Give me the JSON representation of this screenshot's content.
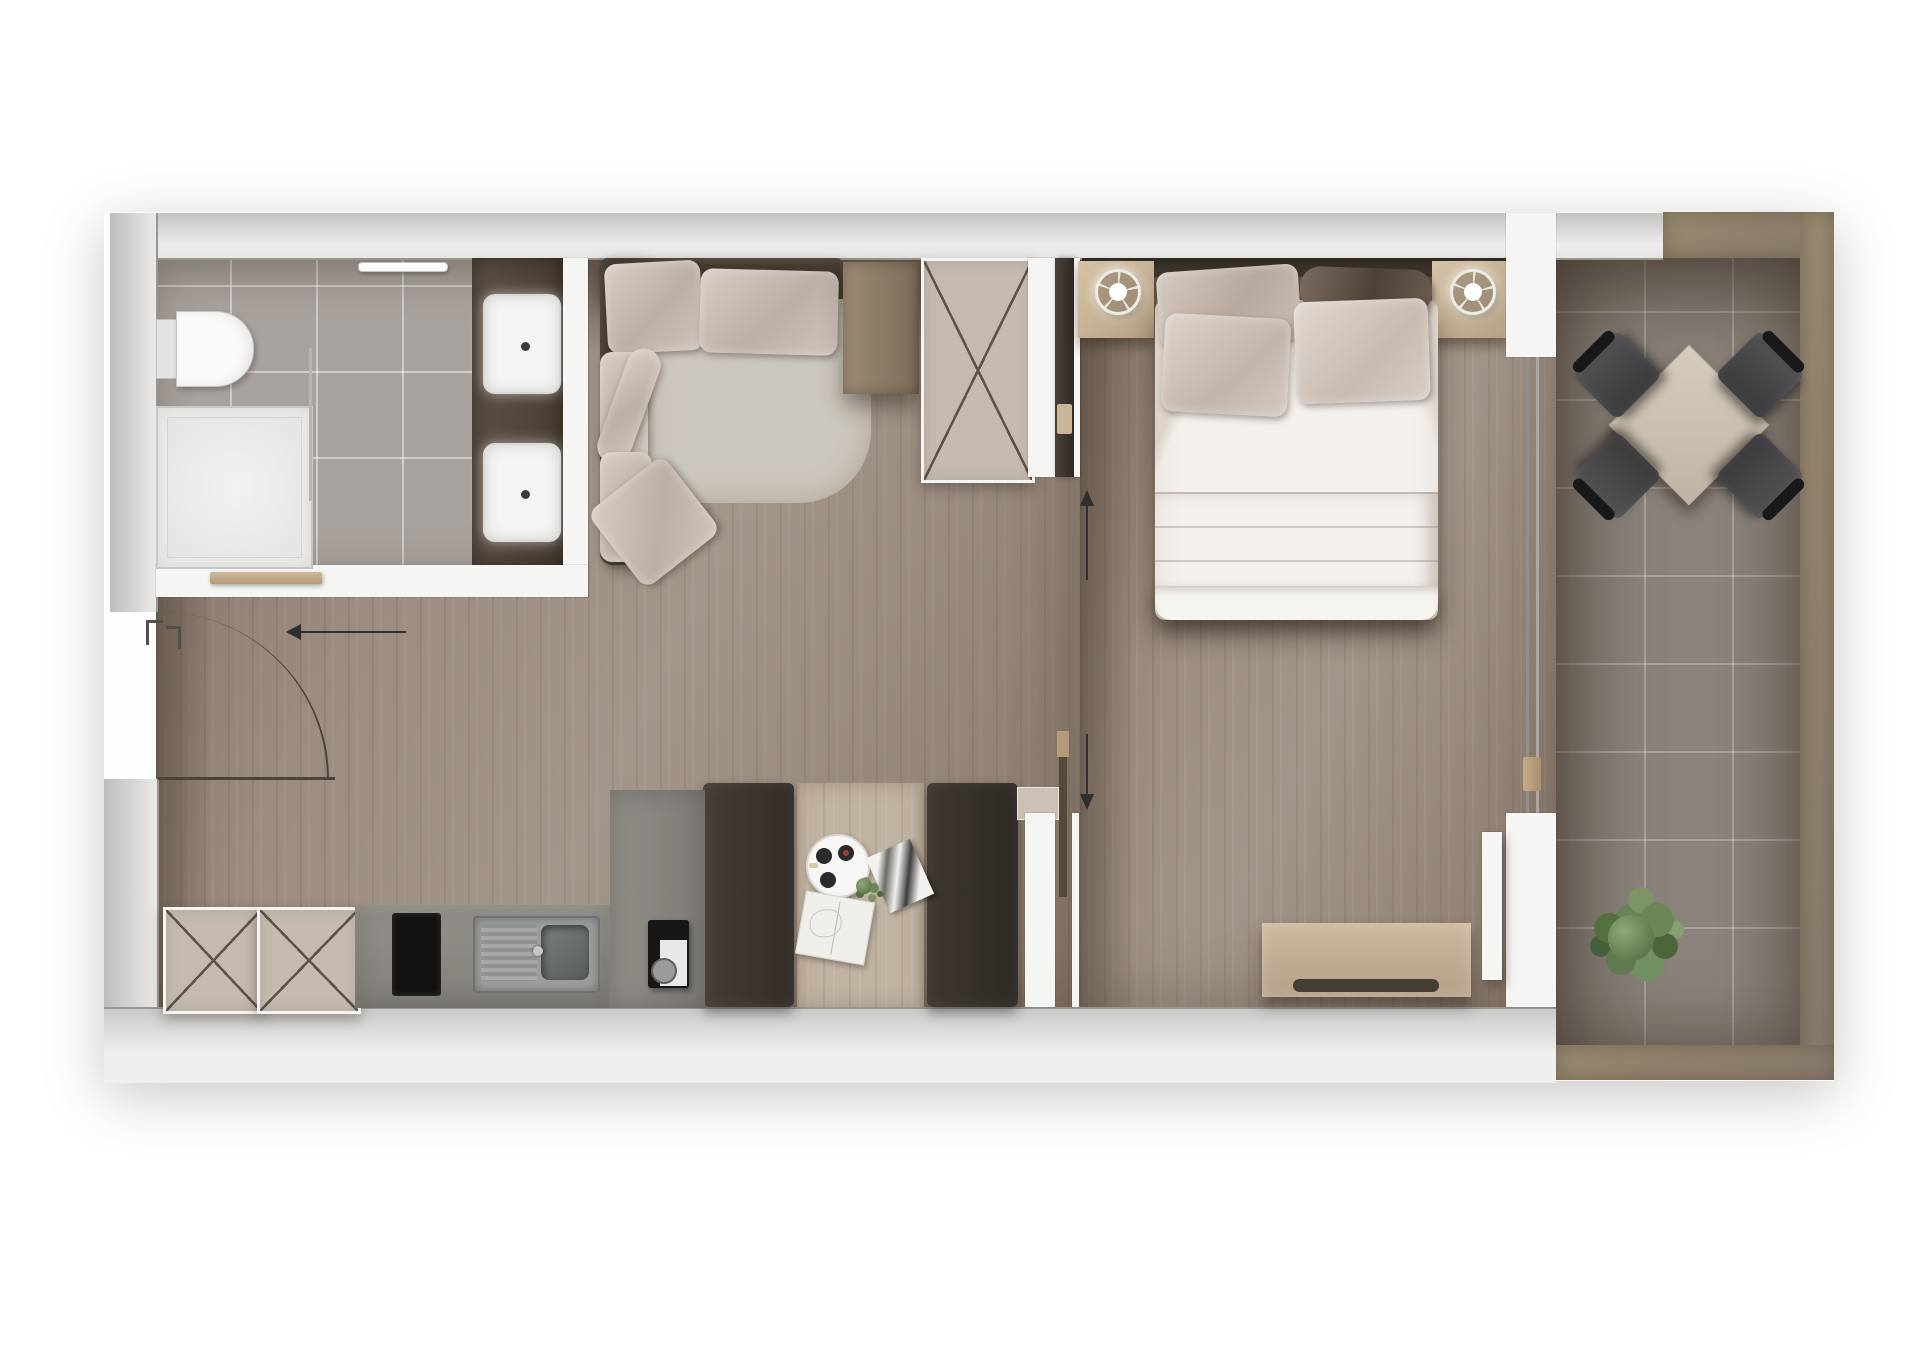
{
  "title": "one-bedroom apartment floor plan, rendered top view",
  "visible_text": [],
  "rooms": [
    {
      "name": "bathroom",
      "items": [
        "toilet",
        "shower-tray",
        "shower-glass-partition",
        "towel-rail",
        "vanity-counter",
        "sink",
        "sink"
      ]
    },
    {
      "name": "entry-hall",
      "items": [
        "entry-door-swing-arc",
        "entry-direction-arrow",
        "console-shelf",
        "shoe-cabinet-x",
        "shoe-cabinet-x"
      ]
    },
    {
      "name": "living-kitchen",
      "items": [
        "corner-sofa",
        "sofa-pillows",
        "side-table",
        "wardrobe-x",
        "kitchen-counter",
        "cooktop",
        "kitchen-sink",
        "coffee-machine",
        "dining-booth-bench",
        "dining-table",
        "serving-tray",
        "magazine",
        "small-plant",
        "open-book",
        "dining-booth-bench"
      ]
    },
    {
      "name": "bedroom",
      "items": [
        "headboard",
        "nightstand-left",
        "table-lamp-left",
        "double-bed",
        "bed-pillows",
        "duvet",
        "blanket",
        "nightstand-right",
        "table-lamp-right",
        "dresser",
        "sliding-door",
        "slide-direction-arrows"
      ]
    },
    {
      "name": "balcony",
      "items": [
        "sliding-glass-door",
        "square-table-diagonal",
        "chair",
        "chair",
        "chair",
        "chair",
        "potted-plant"
      ]
    }
  ],
  "counts": {
    "bathroom_sinks": 2,
    "bed_pillows": 4,
    "balcony_chairs": 4,
    "wardrobe_x_symbols": 3,
    "slide_arrows": 2
  },
  "annotations": {
    "entry_door": "quarter-circle swing arc with leaf line and frame marks",
    "entry_arrow_direction": "left",
    "bedroom_sliding_door_arrows": [
      "up",
      "down"
    ],
    "wardrobe_symbol": "rectangle crossed with X"
  },
  "colors": {
    "page_bg": "#ffffff",
    "inner_wall": "#f5f5f3",
    "wood_floor": "#9c8d80",
    "bath_tile": "#a8a29e",
    "balcony_tile": "#8b837b",
    "balcony_rail": "#8f8070",
    "cabinet_fill": "#c4bab0",
    "cabinet_line": "#5c5349",
    "sofa_frame": "#443b32",
    "sofa_seat": "#ccc7be",
    "pillow_light": "#cfc3bb",
    "pillow_dark": "#6e6156",
    "bed_white": "#f3f0ed",
    "blanket": "#e6ddd3",
    "bench_dark": "#3b342e",
    "table_wood": "#c1b3a2",
    "counter_gray": "#8d8984",
    "cooktop_black": "#111111",
    "steel": "#75797a",
    "nightstand_wood": "#c9b59a",
    "dresser_wood": "#c2ac92",
    "headboard_dark": "#3a332c",
    "chair_dark": "#47474a",
    "plant_green": "#5f7a4e",
    "arrow": "#2f2f2f"
  }
}
